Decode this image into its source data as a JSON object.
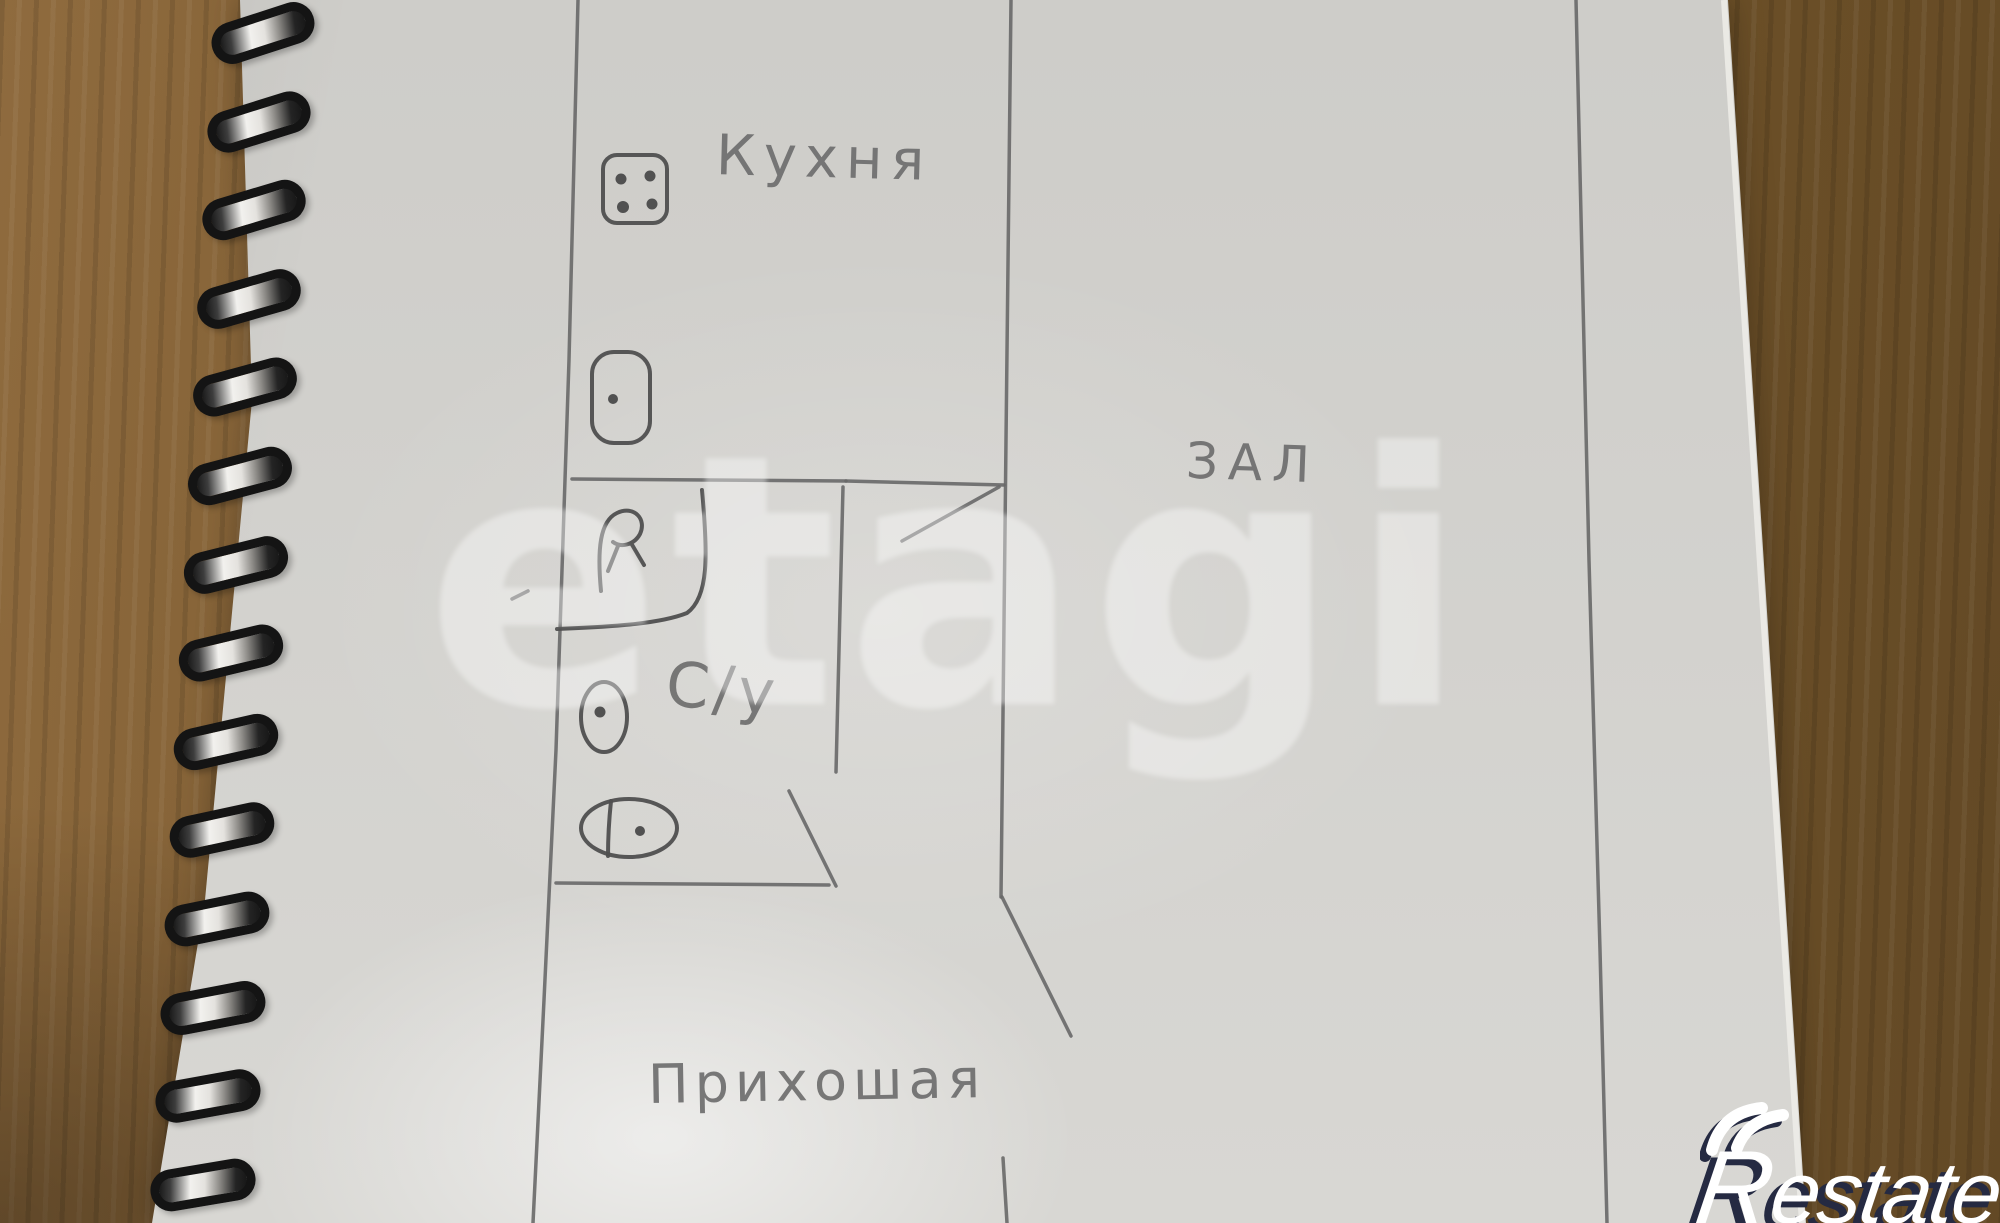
{
  "photo": {
    "subject": "hand-drawn apartment floor plan sketched in pencil on a spiral notebook page lying on a wooden table"
  },
  "floor_plan": {
    "labels": {
      "kitchen": "Кухня",
      "hall": "ЗАЛ",
      "bathroom": "С/у",
      "hallway": "Прихошая"
    },
    "icons": [
      {
        "name": "stove-icon",
        "room": "kitchen"
      },
      {
        "name": "kitchen-sink-icon",
        "room": "kitchen"
      },
      {
        "name": "bathtub-icon",
        "room": "bathroom"
      },
      {
        "name": "toilet-icon",
        "room": "bathroom"
      },
      {
        "name": "washbasin-icon",
        "room": "bathroom"
      }
    ]
  },
  "watermark": {
    "text": "etagi",
    "color": "rgba(255,255,255,0.38)"
  },
  "logo": {
    "full": "Restate",
    "r": "R",
    "rest": "estate",
    "text_color": "#ffffff",
    "shadow_color": "#252a42"
  },
  "notebook": {
    "spiral_ring_count": 14
  },
  "colors": {
    "pencil": "#686868",
    "paper": "#d6d5d1",
    "wood": "#7a5930",
    "ring": "#141414"
  }
}
